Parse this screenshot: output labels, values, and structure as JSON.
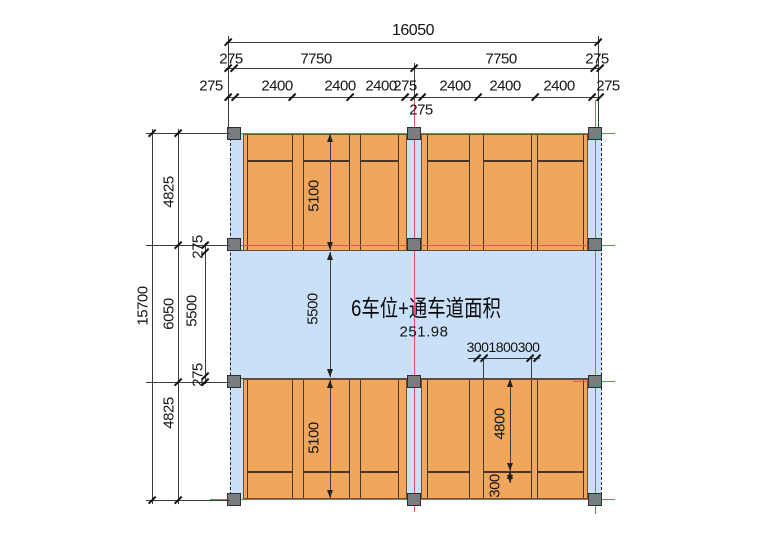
{
  "drawing": {
    "area_label": "6车位+通车道面积",
    "area_value": "251.98"
  },
  "colors": {
    "stall_fill": "#f1a65e",
    "driveway_fill": "#c9e0f8",
    "column_fill": "#797c80",
    "axis_line_red": "#e25555"
  },
  "dimensions": {
    "top_total": "16050",
    "top_bays": [
      "275",
      "7750",
      "7750",
      "275"
    ],
    "top_stalls": [
      "275",
      "2400",
      "2400",
      "2400",
      "275",
      "2400",
      "2400",
      "2400",
      "275"
    ],
    "top_mid_offset": "275",
    "left_total": "15700",
    "left_bands": [
      "4825",
      "6050",
      "4825"
    ],
    "left_drive": [
      "275",
      "5500",
      "275"
    ],
    "stall_depth_top": "5100",
    "drive_width": "5500",
    "stall_depth_bottom": "5100",
    "stall_clear_length": "4800",
    "wheel_stop_offset": "300",
    "stall_width_parts": [
      "300",
      "1800",
      "300"
    ]
  }
}
